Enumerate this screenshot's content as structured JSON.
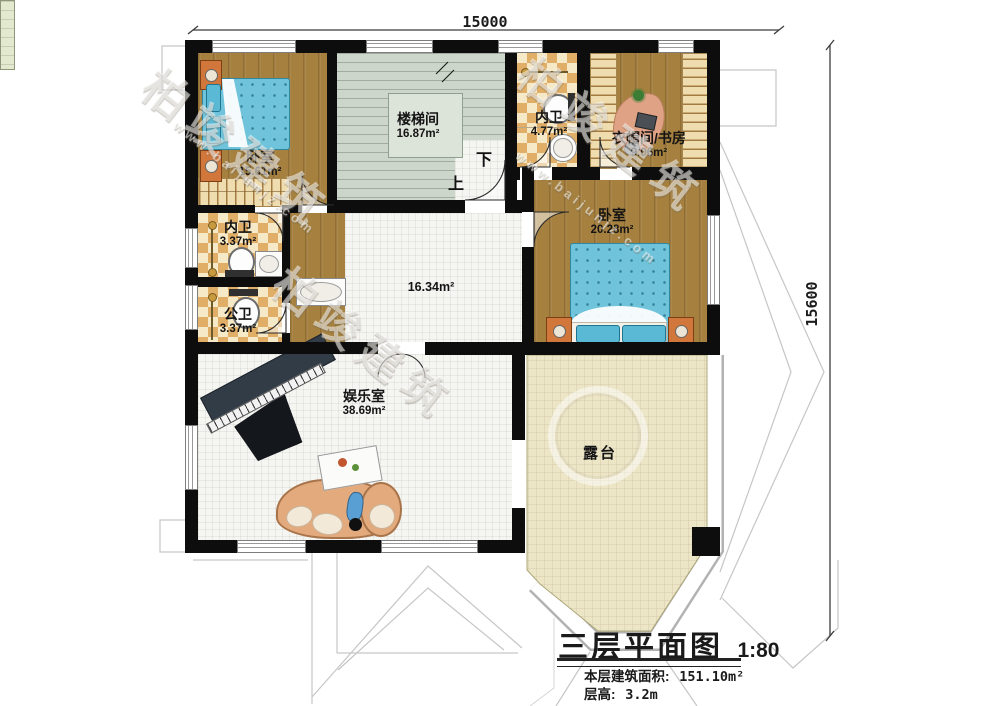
{
  "watermark": {
    "brand": "柏竣建筑",
    "url": "www.baijunjz.com"
  },
  "dimensions": {
    "top": "15000",
    "right": "15600"
  },
  "stairs": {
    "down": "下",
    "up": "上"
  },
  "rooms": {
    "bedroom1": {
      "name": "卧室",
      "area": "15.61m²"
    },
    "stairwell": {
      "name": "楼梯间",
      "area": "16.87m²"
    },
    "bath_top": {
      "name": "内卫",
      "area": "4.77m²"
    },
    "cloak_study": {
      "name": "衣帽间/书房",
      "area": "9.06m²"
    },
    "bath_inner": {
      "name": "内卫",
      "area": "3.37m²"
    },
    "bath_public": {
      "name": "公卫",
      "area": "3.37m²"
    },
    "bedroom2": {
      "name": "卧室",
      "area": "20.28m²"
    },
    "hall": {
      "area": "16.34m²"
    },
    "entertainment": {
      "name": "娱乐室",
      "area": "38.69m²"
    },
    "terrace": {
      "name": "露台"
    }
  },
  "title_block": {
    "title": "三层平面图",
    "scale": "1:80",
    "area_label": "本层建筑面积:",
    "area_value": "151.10m²",
    "height_label": "层高:",
    "height_value": "3.2m"
  }
}
